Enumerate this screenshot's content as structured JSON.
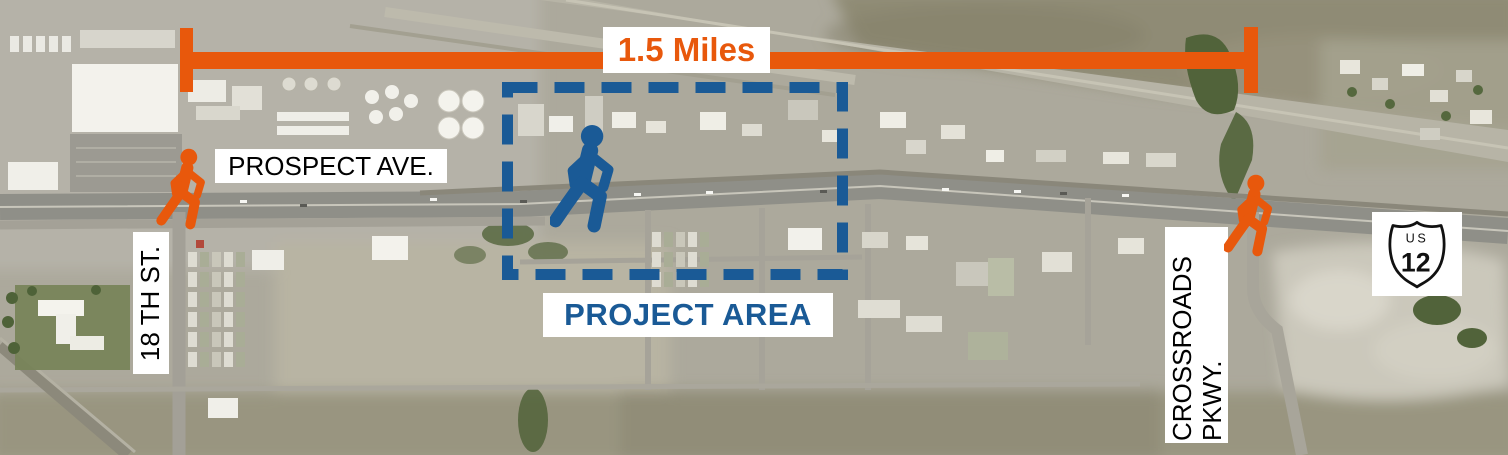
{
  "figure": {
    "type": "annotated-aerial-map",
    "scale_bar": {
      "label": "1.5 Miles"
    },
    "road_labels": {
      "prospect_ave": "PROSPECT AVE.",
      "eighteenth_st": "18 TH ST.",
      "crossroads_pkwy": [
        "CROSSROADS",
        "PKWY."
      ]
    },
    "project_area": {
      "label": "PROJECT AREA"
    },
    "route_shield": {
      "system": "US",
      "number": "12"
    },
    "pedestrian_icons": [
      {
        "name": "pedestrian-icon",
        "location": "18th-st-at-prospect-ave",
        "color": "#E8580C"
      },
      {
        "name": "pedestrian-icon",
        "location": "project-area",
        "color": "#1A5A96"
      },
      {
        "name": "pedestrian-icon",
        "location": "crossroads-pkwy",
        "color": "#E8580C"
      }
    ],
    "colors": {
      "accent_orange": "#E8580C",
      "accent_blue": "#1A5A96",
      "label_background": "#FFFFFF",
      "label_text": "#000000"
    }
  }
}
